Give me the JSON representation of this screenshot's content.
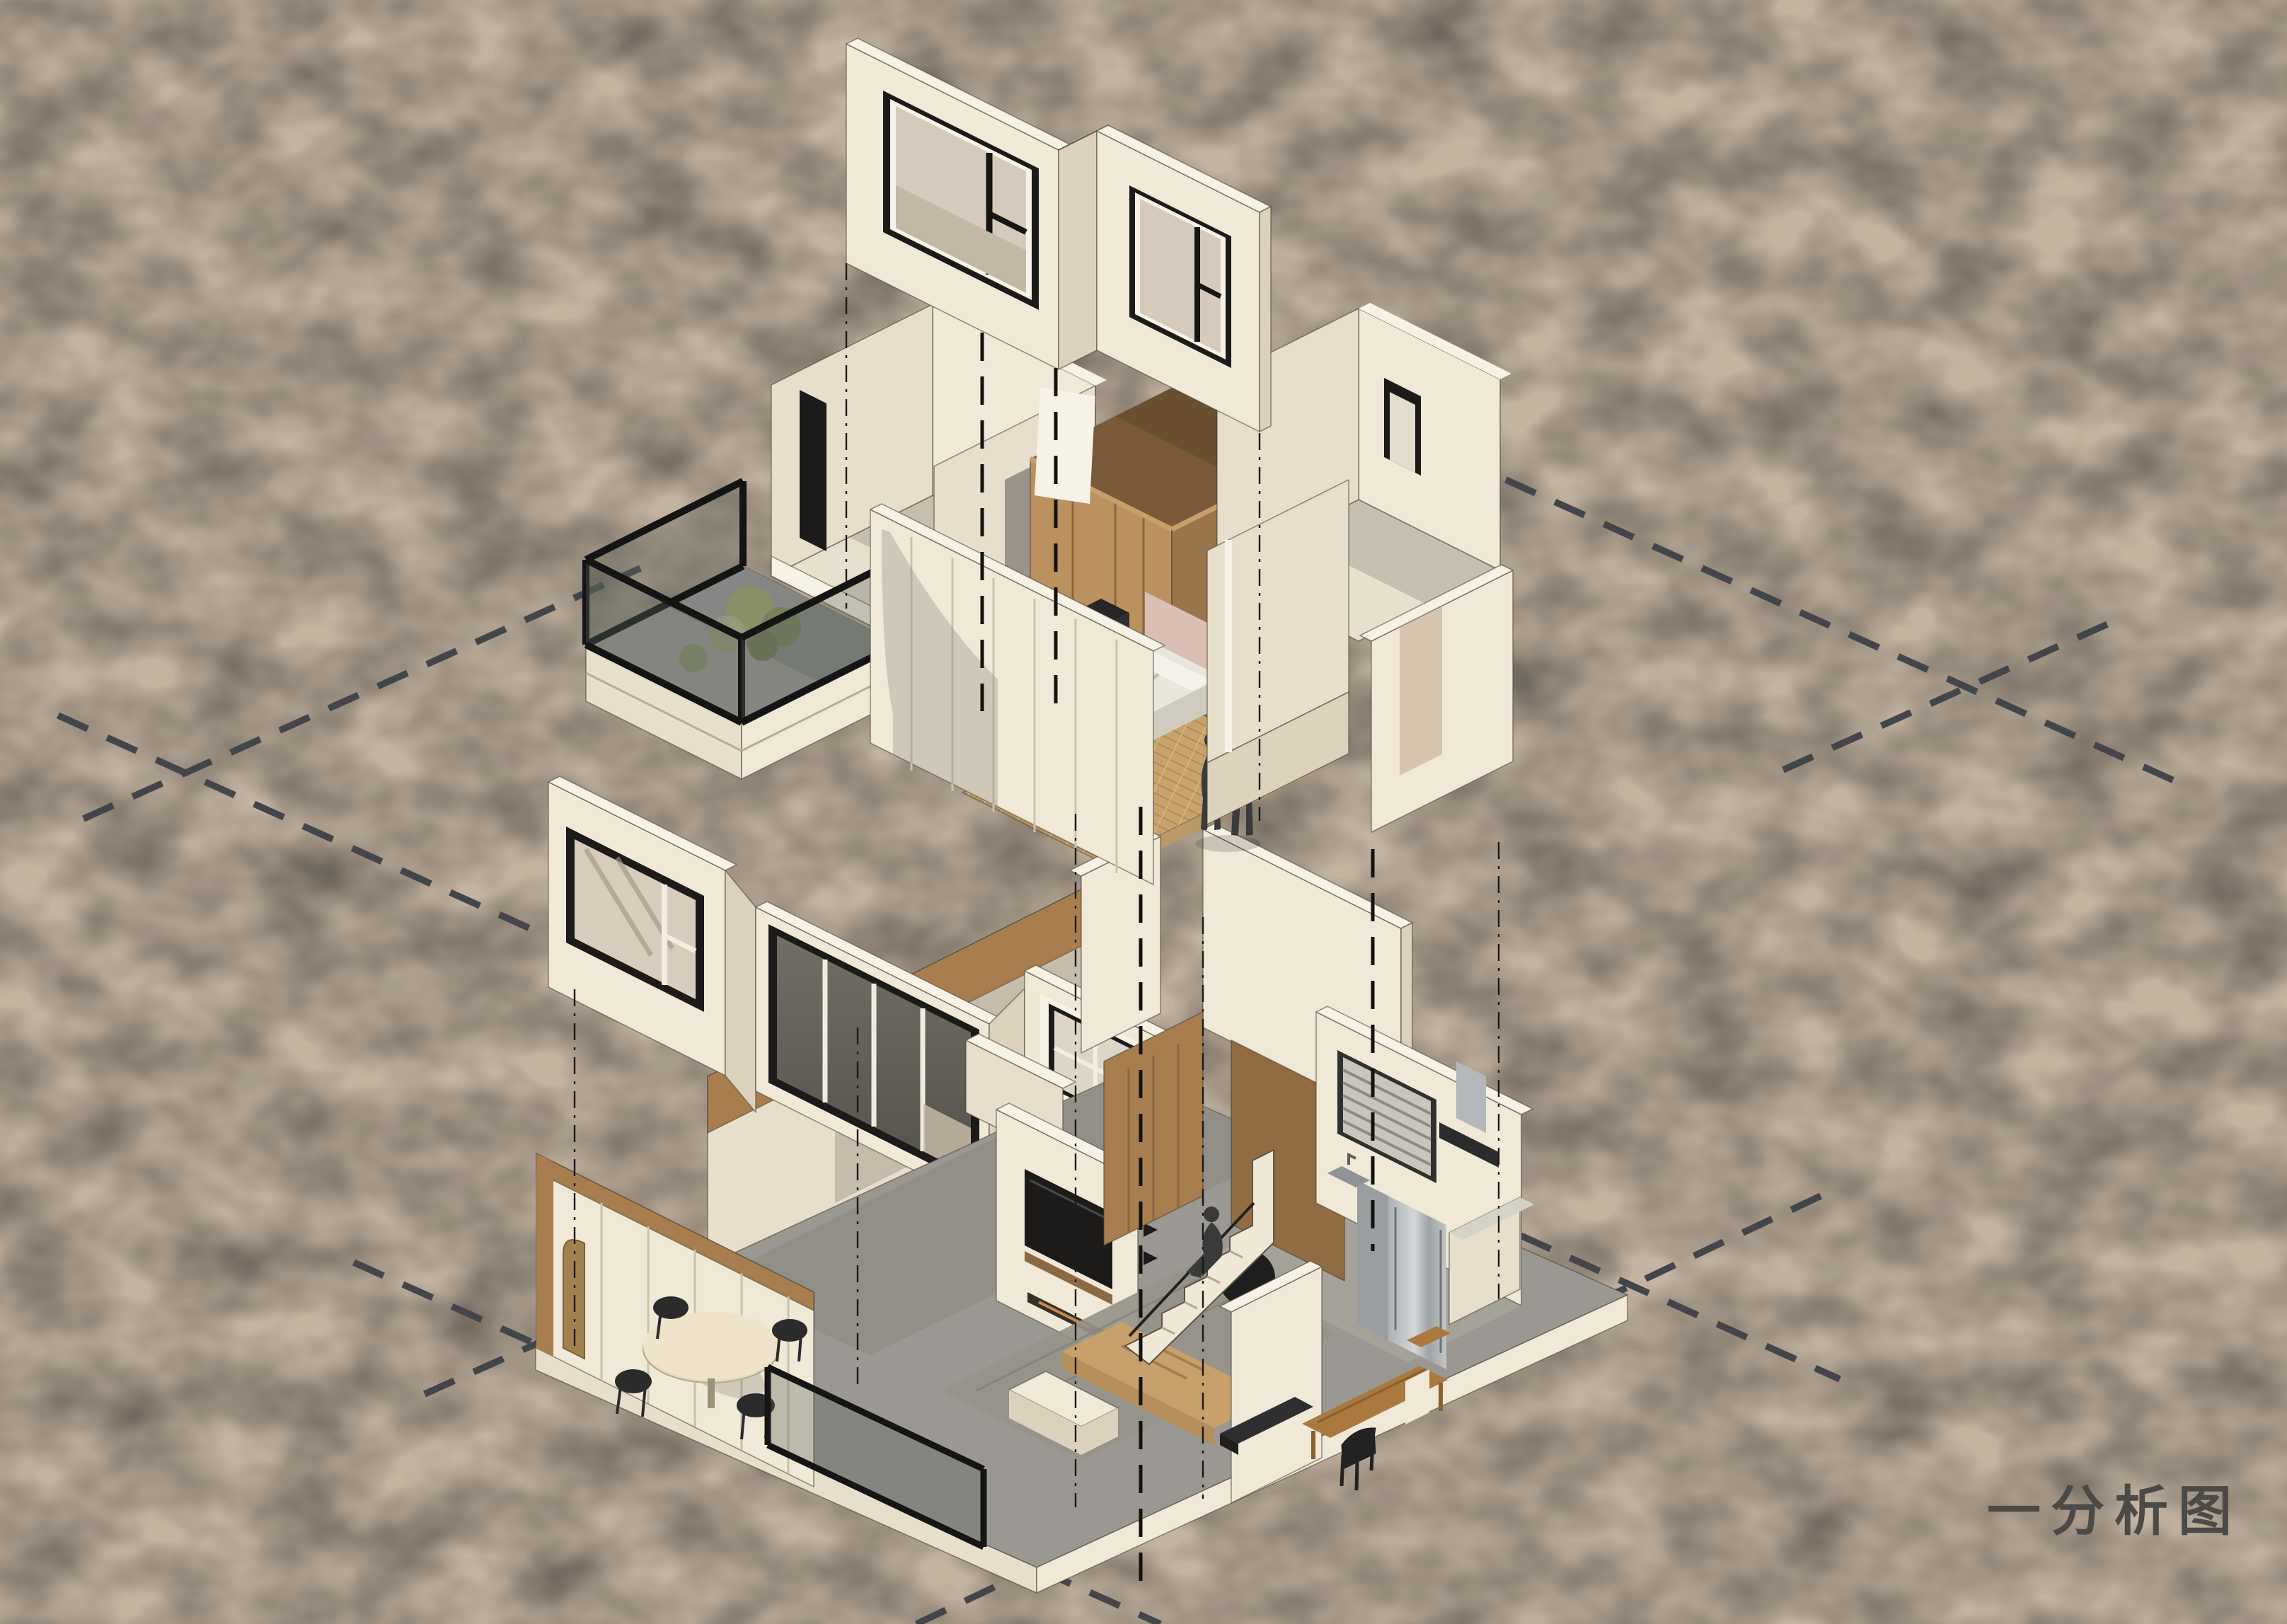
{
  "title": {
    "label": "一分析图"
  },
  "scene": {
    "type": "exploded-axonometric-analysis-diagram",
    "levels": [
      {
        "name": "upper-floor",
        "rooms": [
          "bedroom",
          "balcony",
          "back-room",
          "stair-box",
          "bathroom"
        ]
      },
      {
        "name": "lower-floor",
        "rooms": [
          "dining",
          "living",
          "kitchen",
          "stairwell",
          "study"
        ]
      }
    ],
    "figures": [
      "standing-couple-bedroom",
      "sitting-figure-stairs"
    ]
  },
  "colors": {
    "background": "#d7c5af",
    "background_deep": "#cdb9a0",
    "wall_light": "#f0e9d8",
    "wall_mid": "#e7decc",
    "wall_shade": "#dcd1bc",
    "wall_cut": "#f7f2e6",
    "wood": "#a87e4f",
    "wood_dark": "#916c42",
    "wood_light": "#bb9160",
    "floor_wood": "#c8a36e",
    "floor_grey": "#9b9893",
    "glass_dark": "#66635d",
    "frame_black": "#1c1b19",
    "dash": "#42464a",
    "figure": "#3a3a3a",
    "steel": "#b4b8ba",
    "shadow": "#8e867a",
    "text": "#4b4a47",
    "plant": "#8a9068"
  }
}
